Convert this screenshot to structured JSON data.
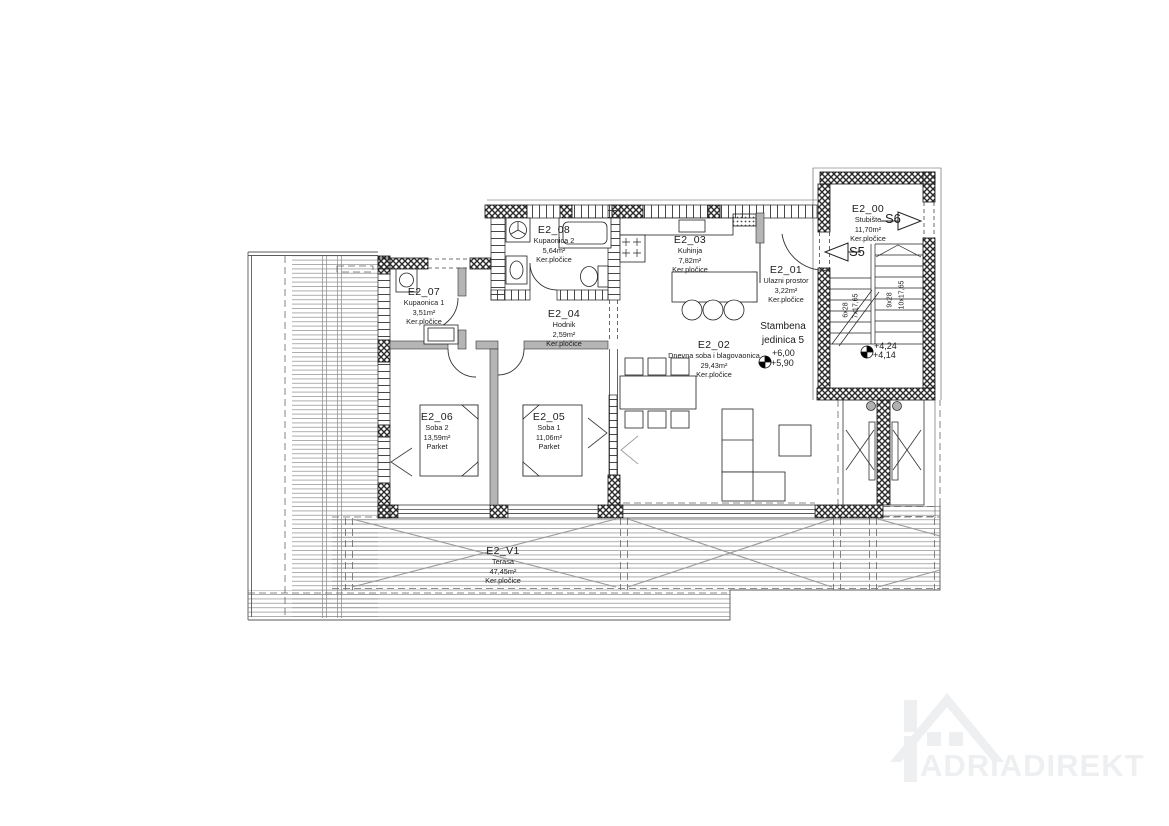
{
  "unit_label": "Stambena jedinica 5",
  "rooms": [
    {
      "id": "E2_00",
      "name": "Stubište",
      "area": "11,70m²",
      "floor": "Ker.pločice"
    },
    {
      "id": "E2_01",
      "name": "Ulazni prostor",
      "area": "3,22m²",
      "floor": "Ker.pločice"
    },
    {
      "id": "E2_02",
      "name": "Dnevna soba i blagovaonica",
      "area": "29,43m²",
      "floor": "Ker.pločice"
    },
    {
      "id": "E2_03",
      "name": "Kuhinja",
      "area": "7,82m²",
      "floor": "Ker.pločice"
    },
    {
      "id": "E2_04",
      "name": "Hodnik",
      "area": "2,59m²",
      "floor": "Ker.pločice"
    },
    {
      "id": "E2_05",
      "name": "Soba 1",
      "area": "11,06m²",
      "floor": "Parket"
    },
    {
      "id": "E2_06",
      "name": "Soba 2",
      "area": "13,59m²",
      "floor": "Parket"
    },
    {
      "id": "E2_07",
      "name": "Kupaonica 1",
      "area": "3,51m²",
      "floor": "Ker.pločice"
    },
    {
      "id": "E2_08",
      "name": "Kupaonica 2",
      "area": "5,64m²",
      "floor": "Ker.pločice"
    },
    {
      "id": "E2_V1",
      "name": "Terasa",
      "area": "47,45m²",
      "floor": "Ker.pločice"
    }
  ],
  "stairwell": {
    "ref_up": "S6",
    "ref_down": "S5",
    "flight_a_risers": "6x28",
    "flight_a_treads": "7x17,65",
    "flight_b_risers": "9x28",
    "flight_b_treads": "10x17,65",
    "level_upper": "+4,24",
    "level_lower": "+4,14"
  },
  "levels": {
    "living_upper": "+6,00",
    "living_lower": "+5,90"
  },
  "watermark": {
    "text": "ADRIADIREKT"
  },
  "colors": {
    "line": "#1a1a1a",
    "wall_hatch": "#2a2a2a",
    "partition_gray": "#b5b5b5",
    "deck_line": "#9a9a9a",
    "watermark": "#edeff1"
  }
}
